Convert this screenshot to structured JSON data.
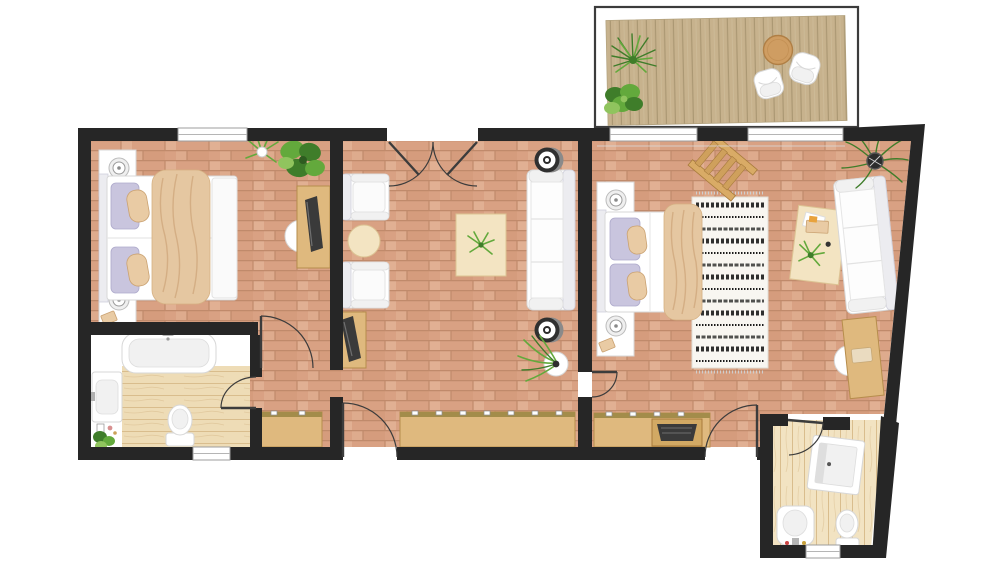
{
  "canvas": {
    "width": 1000,
    "height": 563,
    "background": "#ffffff"
  },
  "palette": {
    "wall": "#262626",
    "brick": "#d9a183",
    "brickLight": "#ecc3a6",
    "brickDark": "#cd9273",
    "brickLine": "#c08a6b",
    "woodFloor": "#eedcb6",
    "woodGrain": "#d9bd8d",
    "deck": "#c7b28d",
    "deckLine": "#ab9873",
    "furnitureWood": "#dfb97e",
    "furnitureWoodEdge": "#b68d4c",
    "wardrobeTop": "#a38c4a",
    "cream": "#f3e4c2",
    "lavender": "#c9c5de",
    "blanket": "#e5c7a1",
    "blanketLine": "#cfa87d",
    "green": "#63a93c",
    "greenDark": "#3f7d2a",
    "greenLight": "#90c45e",
    "rugBase": "#f8f6f1",
    "rugInk": "#1a1a1a"
  },
  "floor_plan": {
    "type": "apartment-floor-plan",
    "rooms": [
      {
        "name": "bedroom-left",
        "floor": "terracotta-brick",
        "furniture": [
          "double-bed",
          "nightstand",
          "nightstand",
          "table-lamp",
          "table-lamp",
          "desk",
          "tv",
          "desk-chair",
          "potted-plant",
          "potted-plant"
        ]
      },
      {
        "name": "bathroom-left",
        "floor": "light-wood",
        "furniture": [
          "bathtub",
          "washbasin",
          "toilet",
          "potted-plant",
          "amenities"
        ]
      },
      {
        "name": "hallway",
        "floor": "terracotta-brick",
        "furniture": [
          "wardrobe"
        ]
      },
      {
        "name": "living-room",
        "floor": "terracotta-brick",
        "furniture": [
          "armchair",
          "armchair",
          "round-side-table",
          "coffee-table",
          "potted-plant",
          "sofa",
          "ceiling-spotlight",
          "ceiling-spotlight",
          "tv-cabinet",
          "tv",
          "wardrobe",
          "potted-plant"
        ]
      },
      {
        "name": "bedroom-right",
        "floor": "terracotta-brick",
        "furniture": [
          "double-bed",
          "nightstand",
          "nightstand",
          "table-lamp",
          "table-lamp",
          "patterned-rug",
          "decorative-ladder",
          "coffee-table",
          "sofa",
          "palm-plant",
          "desk",
          "desk-chair",
          "wardrobe",
          "luggage-rack"
        ]
      },
      {
        "name": "bathroom-right",
        "floor": "light-wood",
        "furniture": [
          "shower",
          "washbasin",
          "toilet"
        ]
      },
      {
        "name": "terrace",
        "floor": "wood-deck",
        "furniture": [
          "round-table",
          "lounge-chair",
          "lounge-chair",
          "potted-plant",
          "potted-plant"
        ]
      }
    ],
    "openings": [
      "window",
      "window",
      "window",
      "window",
      "terrace-doors",
      "french-doors",
      "entrance-door",
      "interior-door",
      "interior-door",
      "interior-door",
      "interior-door",
      "interior-door"
    ]
  }
}
